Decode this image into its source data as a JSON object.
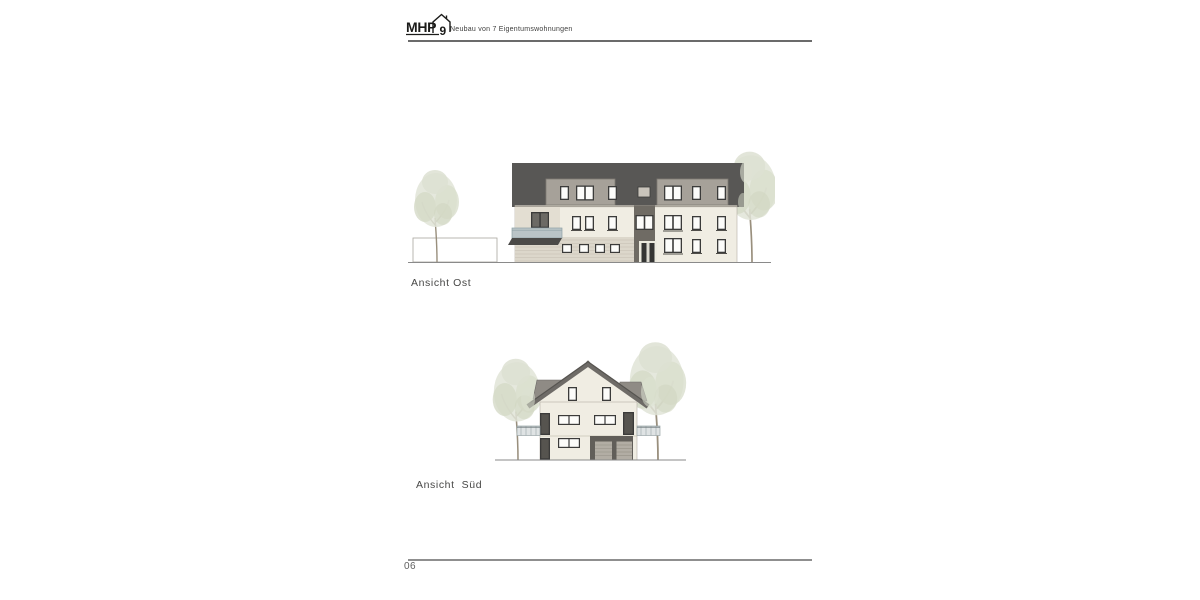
{
  "header": {
    "logo": {
      "text": "MHP",
      "number": "9",
      "icon": "house-outline-icon"
    },
    "project_title": "Neubau von 7 Eigentumswohnungen"
  },
  "drawings": [
    {
      "label": "Ansicht Ost"
    },
    {
      "label": "Ansicht  Süd"
    }
  ],
  "footer": {
    "page_number": "06"
  },
  "colors": {
    "roof_dark": "#585755",
    "dormer_face": "#a6a199",
    "facade_cream": "#f0ede3",
    "siding_light": "#dcd7cb",
    "window_frame": "#3b3b3a",
    "stairwell_accent": "#6f6b64",
    "balcony_glass": "#bac4c7",
    "foliage_pale": "#dde1d2",
    "rule_gray": "#8c8c8c",
    "text_dark": "#474746"
  }
}
